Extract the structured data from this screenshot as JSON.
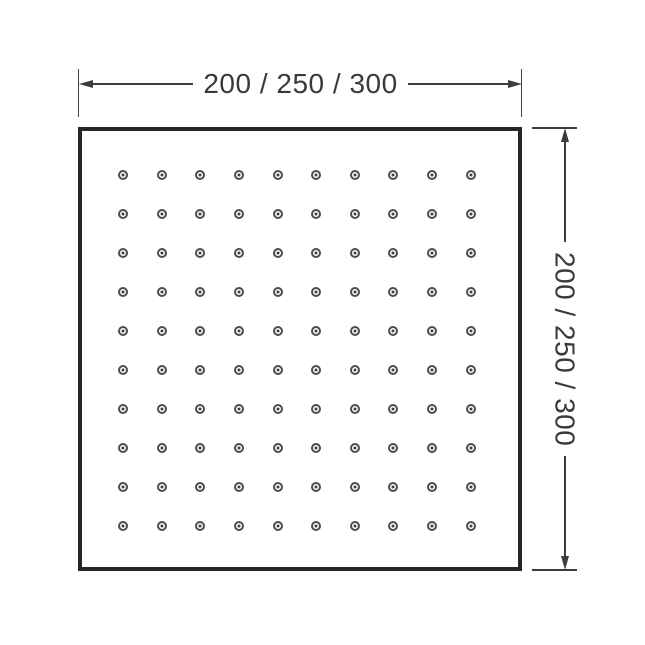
{
  "diagram": {
    "type": "shower-head-dimension-drawing",
    "width_label": "200 / 250 / 300",
    "height_label": "200 / 250 / 300",
    "nozzle_grid": {
      "rows": 10,
      "cols": 10
    },
    "colors": {
      "background": "#ffffff",
      "outline": "#262626",
      "dimension": "#3d3d3d",
      "text": "#3a3a3a",
      "nozzle_ring": "#4d4d4d",
      "nozzle_center": "#414141"
    }
  }
}
